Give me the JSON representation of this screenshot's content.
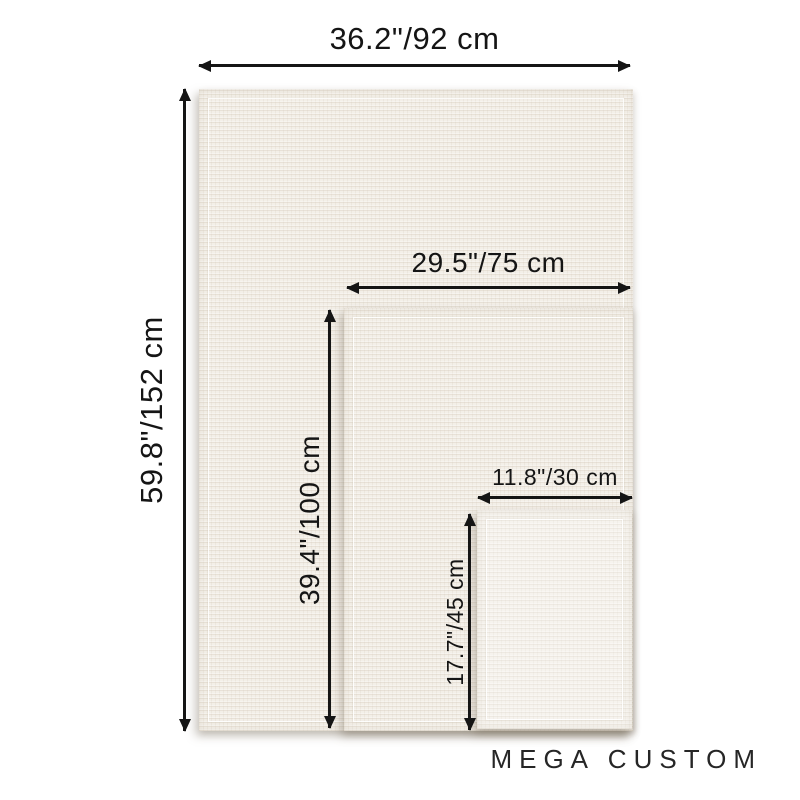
{
  "brand": "MEGA CUSTOM",
  "sizes": [
    {
      "name": "large",
      "width_label": "36.2\"/92 cm",
      "height_label": "59.8\"/152 cm",
      "width_in": 36.2,
      "width_cm": 92,
      "height_in": 59.8,
      "height_cm": 152
    },
    {
      "name": "medium",
      "width_label": "29.5\"/75 cm",
      "height_label": "39.4\"/100 cm",
      "width_in": 29.5,
      "width_cm": 75,
      "height_in": 39.4,
      "height_cm": 100
    },
    {
      "name": "small",
      "width_label": "11.8\"/30 cm",
      "height_label": "17.7\"/45 cm",
      "width_in": 11.8,
      "width_cm": 30,
      "height_in": 17.7,
      "height_cm": 45
    }
  ],
  "colors": {
    "background": "#ffffff",
    "canvas": "#f3efe8",
    "canvas_small": "#f6f3ee",
    "ink": "#151515",
    "brand_text": "#262626"
  }
}
